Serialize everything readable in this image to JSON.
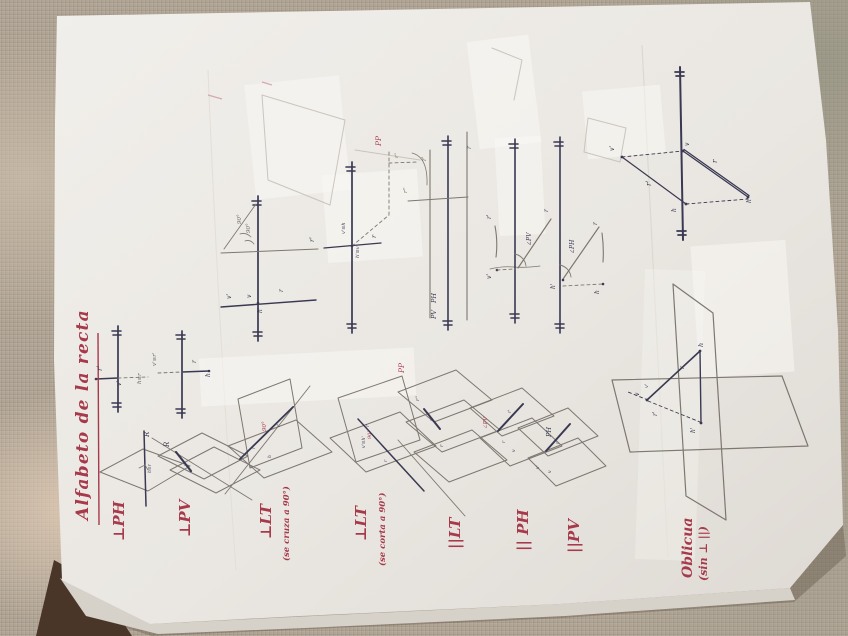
{
  "page": {
    "title": "Alfabeto de la recta",
    "rows": [
      {
        "id": "perp-ph",
        "label": "⊥PH"
      },
      {
        "id": "perp-pv",
        "label": "⊥PV"
      },
      {
        "id": "perp-lt-cruza",
        "label": "⊥LT",
        "sublabel": "(se cruza a 90°)"
      },
      {
        "id": "perp-lt-corta",
        "label": "⊥LT",
        "sublabel": "(se corta a 90°)"
      },
      {
        "id": "par-lt",
        "label": "||LT"
      },
      {
        "id": "par-ph",
        "label": "|| PH"
      },
      {
        "id": "par-pv",
        "label": "||PV"
      },
      {
        "id": "oblicua",
        "label": "Oblicua",
        "sublabel": "(sin ⊥ ||)"
      }
    ]
  },
  "colors": {
    "ink": "#3a3852",
    "pencil": "#6e675f",
    "red": "#a63a4b"
  },
  "annotations": [
    {
      "t": "r'",
      "x": 102,
      "y": 371,
      "s": 7,
      "c": "ink"
    },
    {
      "t": "v'",
      "x": 121,
      "y": 386,
      "s": 6,
      "c": "ink"
    },
    {
      "t": "h≡r",
      "x": 141,
      "y": 384,
      "s": 5.5,
      "c": "pencil"
    },
    {
      "t": "v'≡r'",
      "x": 156,
      "y": 366,
      "s": 5.5,
      "c": "pencil"
    },
    {
      "t": "r",
      "x": 196,
      "y": 363,
      "s": 6,
      "c": "ink"
    },
    {
      "t": "h",
      "x": 210,
      "y": 377,
      "s": 6,
      "c": "ink"
    },
    {
      "t": "90°",
      "x": 241,
      "y": 224,
      "s": 5.5,
      "c": "pencil"
    },
    {
      "t": "90°",
      "x": 250,
      "y": 233,
      "s": 5.5,
      "c": "pencil"
    },
    {
      "t": "r'",
      "x": 314,
      "y": 242,
      "s": 6.5,
      "c": "ink"
    },
    {
      "t": "v'",
      "x": 231,
      "y": 299,
      "s": 6,
      "c": "ink"
    },
    {
      "t": "v",
      "x": 251,
      "y": 298,
      "s": 6,
      "c": "ink"
    },
    {
      "t": "r",
      "x": 283,
      "y": 292,
      "s": 6,
      "c": "ink"
    },
    {
      "t": "h'",
      "x": 262,
      "y": 313,
      "s": 6,
      "c": "ink"
    },
    {
      "t": "v'≡h",
      "x": 345,
      "y": 234,
      "s": 5,
      "c": "ink"
    },
    {
      "t": "h'≡v",
      "x": 359,
      "y": 258,
      "s": 5,
      "c": "ink"
    },
    {
      "t": "r",
      "x": 376,
      "y": 238,
      "s": 6.5,
      "c": "ink"
    },
    {
      "t": "PP",
      "x": 381,
      "y": 146,
      "s": 7.5,
      "c": "red"
    },
    {
      "t": "r''",
      "x": 398,
      "y": 158,
      "s": 5,
      "c": "pencil"
    },
    {
      "t": "r'",
      "x": 426,
      "y": 161,
      "s": 6,
      "c": "pencil"
    },
    {
      "t": "r",
      "x": 471,
      "y": 149,
      "s": 6,
      "c": "pencil"
    },
    {
      "t": "r''",
      "x": 407,
      "y": 193,
      "s": 5.5,
      "c": "pencil"
    },
    {
      "t": "PH",
      "x": 436,
      "y": 303,
      "s": 6.5,
      "c": "ink"
    },
    {
      "t": "PV",
      "x": 436,
      "y": 319,
      "s": 6.5,
      "c": "ink"
    },
    {
      "t": "r'",
      "x": 491,
      "y": 219,
      "s": 6,
      "c": "ink"
    },
    {
      "t": "v'",
      "x": 491,
      "y": 279,
      "s": 6,
      "c": "ink"
    },
    {
      "t": "∠PV",
      "x": 531,
      "y": 246,
      "s": 6,
      "c": "ink"
    },
    {
      "t": "r",
      "x": 548,
      "y": 212,
      "s": 6,
      "c": "ink"
    },
    {
      "t": "∠PH",
      "x": 574,
      "y": 254,
      "s": 6,
      "c": "ink"
    },
    {
      "t": "h'",
      "x": 555,
      "y": 289,
      "s": 6,
      "c": "ink"
    },
    {
      "t": "h",
      "x": 599,
      "y": 294,
      "s": 6,
      "c": "ink"
    },
    {
      "t": "r",
      "x": 597,
      "y": 225,
      "s": 6,
      "c": "ink"
    },
    {
      "t": "r",
      "x": 717,
      "y": 163,
      "s": 7,
      "c": "ink"
    },
    {
      "t": "r'",
      "x": 651,
      "y": 186,
      "s": 7,
      "c": "ink"
    },
    {
      "t": "v",
      "x": 689,
      "y": 146,
      "s": 6,
      "c": "ink"
    },
    {
      "t": "v'",
      "x": 614,
      "y": 151,
      "s": 6,
      "c": "ink"
    },
    {
      "t": "h",
      "x": 676,
      "y": 212,
      "s": 6,
      "c": "ink"
    },
    {
      "t": "h'",
      "x": 751,
      "y": 203,
      "s": 6,
      "c": "ink"
    },
    {
      "t": "R",
      "x": 149,
      "y": 437,
      "s": 7,
      "c": "ink"
    },
    {
      "t": "h≡r",
      "x": 151,
      "y": 473,
      "s": 4.5,
      "c": "ink"
    },
    {
      "t": "R",
      "x": 169,
      "y": 447,
      "s": 7,
      "c": "ink"
    },
    {
      "t": "v'",
      "x": 187,
      "y": 466,
      "s": 4.5,
      "c": "ink"
    },
    {
      "t": "90°",
      "x": 266,
      "y": 431,
      "s": 5.5,
      "c": "red"
    },
    {
      "t": "r'",
      "x": 280,
      "y": 427,
      "s": 4.5,
      "c": "ink"
    },
    {
      "t": "r",
      "x": 255,
      "y": 449,
      "s": 4.5,
      "c": "ink"
    },
    {
      "t": "h",
      "x": 271,
      "y": 458,
      "s": 4.5,
      "c": "ink"
    },
    {
      "t": "90°",
      "x": 371,
      "y": 439,
      "s": 5,
      "c": "red"
    },
    {
      "t": "v'≡h'",
      "x": 365,
      "y": 448,
      "s": 4.5,
      "c": "ink"
    },
    {
      "t": "r'",
      "x": 369,
      "y": 427,
      "s": 4.5,
      "c": "ink"
    },
    {
      "t": "r",
      "x": 387,
      "y": 462,
      "s": 4.5,
      "c": "ink"
    },
    {
      "t": "PP",
      "x": 404,
      "y": 373,
      "s": 7.5,
      "c": "red"
    },
    {
      "t": "r''",
      "x": 419,
      "y": 401,
      "s": 5,
      "c": "ink"
    },
    {
      "t": "r'",
      "x": 433,
      "y": 421,
      "s": 5,
      "c": "ink"
    },
    {
      "t": "r",
      "x": 443,
      "y": 447,
      "s": 5,
      "c": "ink"
    },
    {
      "t": "∠PV",
      "x": 487,
      "y": 429,
      "s": 5.5,
      "c": "red"
    },
    {
      "t": "r'",
      "x": 511,
      "y": 413,
      "s": 4.5,
      "c": "ink"
    },
    {
      "t": "r",
      "x": 505,
      "y": 443,
      "s": 4.5,
      "c": "ink"
    },
    {
      "t": "v",
      "x": 515,
      "y": 452,
      "s": 4.5,
      "c": "ink"
    },
    {
      "t": "PH",
      "x": 551,
      "y": 437,
      "s": 6.5,
      "c": "ink"
    },
    {
      "t": "r",
      "x": 559,
      "y": 444,
      "s": 4.5,
      "c": "ink"
    },
    {
      "t": "v",
      "x": 551,
      "y": 473,
      "s": 4.5,
      "c": "ink"
    },
    {
      "t": "v'",
      "x": 539,
      "y": 469,
      "s": 4.5,
      "c": "ink"
    },
    {
      "t": "h",
      "x": 703,
      "y": 347,
      "s": 6.5,
      "c": "ink"
    },
    {
      "t": "v",
      "x": 639,
      "y": 396,
      "s": 6,
      "c": "ink"
    },
    {
      "t": "r",
      "x": 684,
      "y": 369,
      "s": 6,
      "c": "ink"
    },
    {
      "t": "r'",
      "x": 657,
      "y": 416,
      "s": 6,
      "c": "ink"
    },
    {
      "t": "h'",
      "x": 695,
      "y": 433,
      "s": 6,
      "c": "ink"
    },
    {
      "t": "v'",
      "x": 648,
      "y": 388,
      "s": 5,
      "c": "ink"
    }
  ]
}
